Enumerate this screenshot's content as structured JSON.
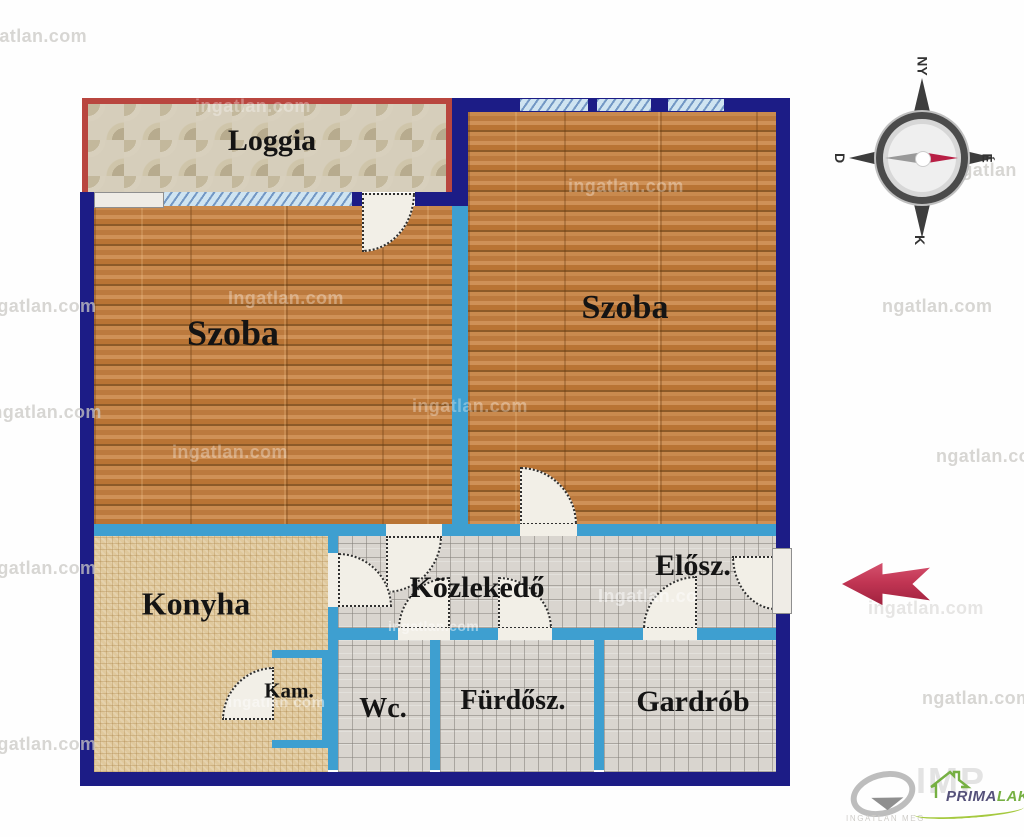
{
  "plan": {
    "rooms": [
      {
        "id": "loggia",
        "label": "Loggia"
      },
      {
        "id": "szoba-left",
        "label": "Szoba"
      },
      {
        "id": "szoba-right",
        "label": "Szoba"
      },
      {
        "id": "konyha",
        "label": "Konyha"
      },
      {
        "id": "kozlekedo",
        "label": "Közlekedő"
      },
      {
        "id": "eloszoba",
        "label": "Elősz."
      },
      {
        "id": "kamra",
        "label": "Kam."
      },
      {
        "id": "wc",
        "label": "Wc."
      },
      {
        "id": "furdoszoba",
        "label": "Fürdősz."
      },
      {
        "id": "gardrob",
        "label": "Gardrób"
      }
    ]
  },
  "compass": {
    "west": "NY",
    "south": "D",
    "north": "É",
    "east": "K"
  },
  "watermarks": [
    "gatlan.com",
    "ingatlan.com",
    "ngatlan.com",
    "Ingatlan.com",
    "ingatlan.com",
    "ingatlan.com",
    "ingatlan.com",
    "Ingatlan.com",
    "ngatlan.com",
    "ngatlan.com",
    "Ingatlan.co",
    "ingatlan.com",
    "ingatlan com",
    "ngatlan",
    "ngatlan.com",
    "ngatlan.com",
    "ingatlan.com",
    "ngatlan.com"
  ],
  "branding": {
    "portal_text": "INGATLAN MEG",
    "watermark_big": "IMP",
    "agency_prefix": "PRIMA",
    "agency_suffix": "LAK"
  },
  "colors": {
    "outer_wall": "#1c1c86",
    "inner_wall": "#3e9fd0",
    "loggia_border": "#b9463f",
    "window": "#cfe4f1",
    "entry_arrow": "#c23654",
    "compass_needle": "#b81f45",
    "agency_green": "#76b043",
    "agency_purple": "#55517a"
  }
}
